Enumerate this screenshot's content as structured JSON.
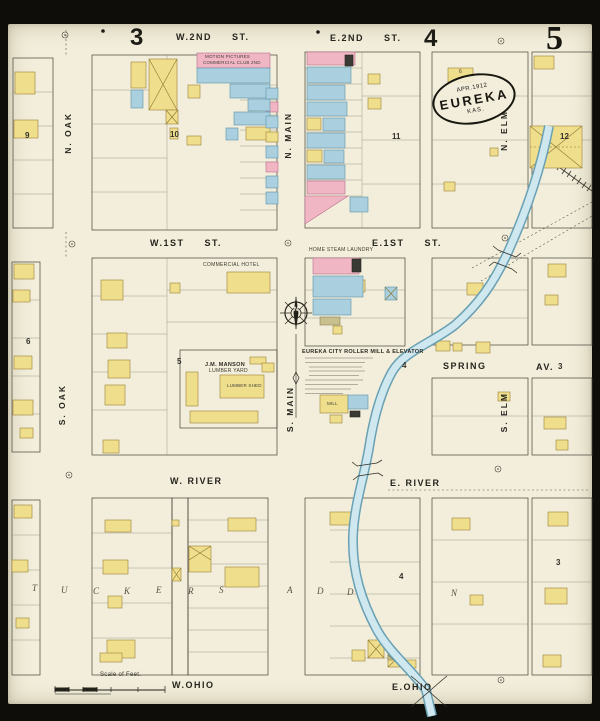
{
  "sheet": {
    "adjacent_left": "3",
    "adjacent_right": "4",
    "number": "5",
    "seal_date": "APR.1912",
    "seal_city": "EUREKA",
    "seal_state": "KAS.",
    "scale_label": "Scale of Feet."
  },
  "streets": {
    "w_2nd": "W.2ND ST.",
    "e_2nd": "E.2ND ST.",
    "w_1st": "W.1ST ST.",
    "e_1st": "E.1ST ST.",
    "spring": "SPRING",
    "spring_av": "AV.",
    "w_river": "W. RIVER",
    "e_river": "E. RIVER",
    "w_ohio": "W.OHIO",
    "e_ohio": "E.OHIO",
    "n_oak": "N. OAK",
    "s_oak": "S. OAK",
    "n_main": "N. MAIN",
    "s_main": "S. MAIN",
    "n_elm": "N. ELM",
    "s_elm": "S. ELM"
  },
  "block_numbers": {
    "b9": "9",
    "b10": "10",
    "b11": "11",
    "b12": "12",
    "b6": "6",
    "b5": "5",
    "b4_spring": "4",
    "b3_spring": "3",
    "b4_south": "4",
    "b3_south": "3",
    "lot6": "6"
  },
  "landmarks": {
    "motion_pictures": "MOTION PICTURES",
    "commercial_club": "COMMERCIAL CLUB 2ND",
    "commercial_hotel": "COMMERCIAL HOTEL",
    "home_steam_laundry": "HOME STEAM LAUNDRY",
    "mill_title": "EUREKA CITY ROLLER MILL & ELEVATOR",
    "mill_label": "MILL",
    "manson_name": "J.M. MANSON",
    "manson_type": "LUMBER YARD",
    "lumber_shed": "LUMBER SHED"
  },
  "addition": {
    "name_letters": [
      "T",
      "U",
      "C",
      "K",
      "E",
      "R",
      "S"
    ],
    "addn_letters": [
      "A",
      "D",
      "D",
      "N"
    ]
  },
  "compass": {
    "north": "N"
  },
  "legend_colors": {
    "frame": "#efdf8d",
    "brick": "#f1b6c4",
    "stone": "#aacfdf",
    "paper": "#f2eedb"
  }
}
